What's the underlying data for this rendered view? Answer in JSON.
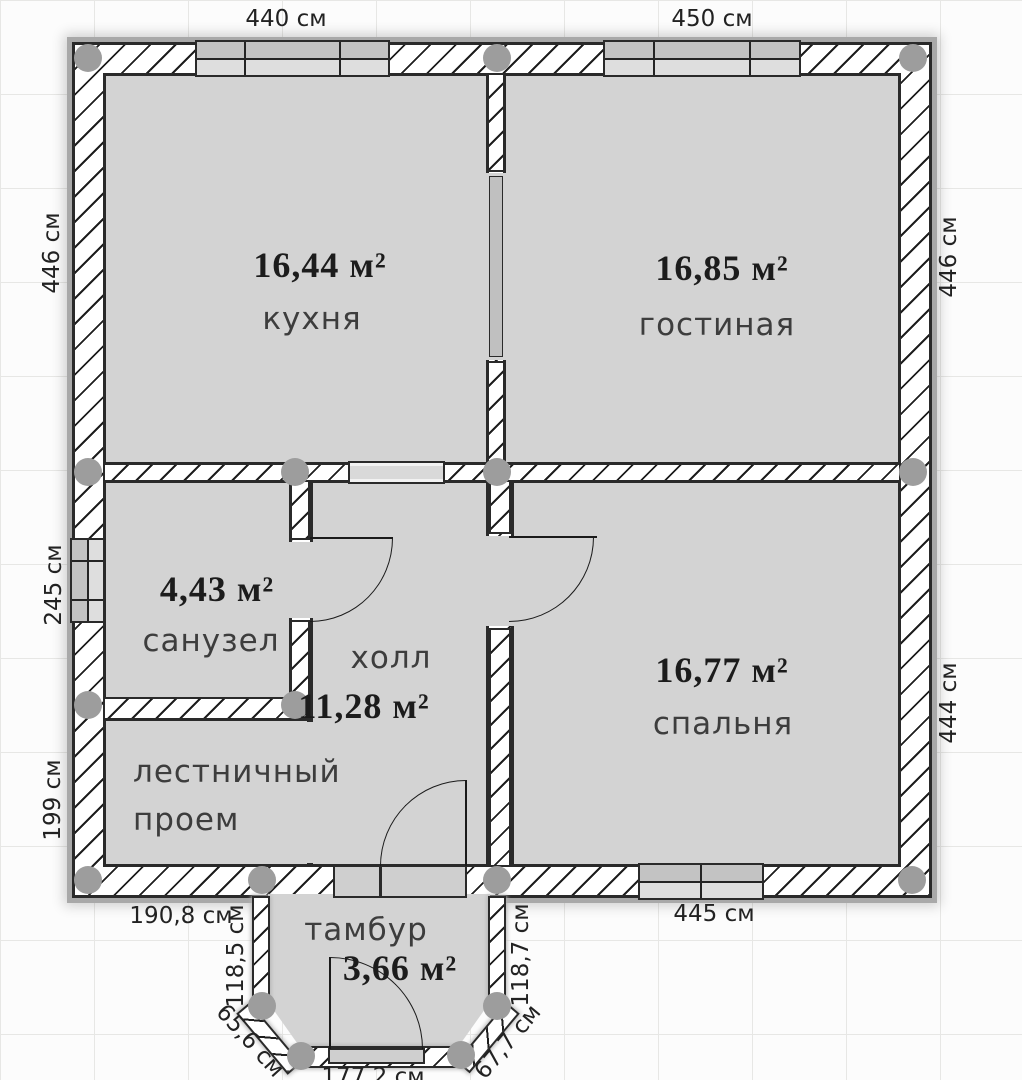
{
  "rooms": {
    "kitchen": {
      "area": "16,44 м²",
      "name": "кухня"
    },
    "living_room": {
      "area": "16,85 м²",
      "name": "гостиная"
    },
    "bathroom": {
      "area": "4,43 м²",
      "name": "санузел"
    },
    "hall": {
      "area": "11,28 м²",
      "name": "холл"
    },
    "stairwell": {
      "name": "лестничный проем"
    },
    "bedroom": {
      "area": "16,77 м²",
      "name": "спальня"
    },
    "vestibule": {
      "area": "3,66 м²",
      "name": "тамбур"
    }
  },
  "dimensions": {
    "top_kitchen": "440 см",
    "top_living": "450 см",
    "left_kitchen": "446 см",
    "left_bathroom": "245 см",
    "left_stairwell": "199 см",
    "right_living": "446 см",
    "right_bedroom": "444 см",
    "bottom_stairwell": "190,8 см",
    "bottom_bedroom": "445 см",
    "vestibule_left": "118,5 см",
    "vestibule_right": "118,7 см",
    "vestibule_left_diagonal": "65,6 см",
    "vestibule_right_diagonal": "67,7 см",
    "vestibule_bottom": "177,2 см"
  },
  "colors": {
    "room_fill": "#d3d3d3",
    "wall_outline": "#2a2a2a",
    "wall_fill": "#ffffff",
    "hatch_line": "#1e1e1e",
    "corner_marker": "#9d9d9d",
    "window_pane_dark": "#c3c3c3",
    "window_pane_light": "#dedede",
    "grid_line": "#e7e7e5",
    "background": "#fcfcfc",
    "label_text": "#1c1c1c"
  }
}
